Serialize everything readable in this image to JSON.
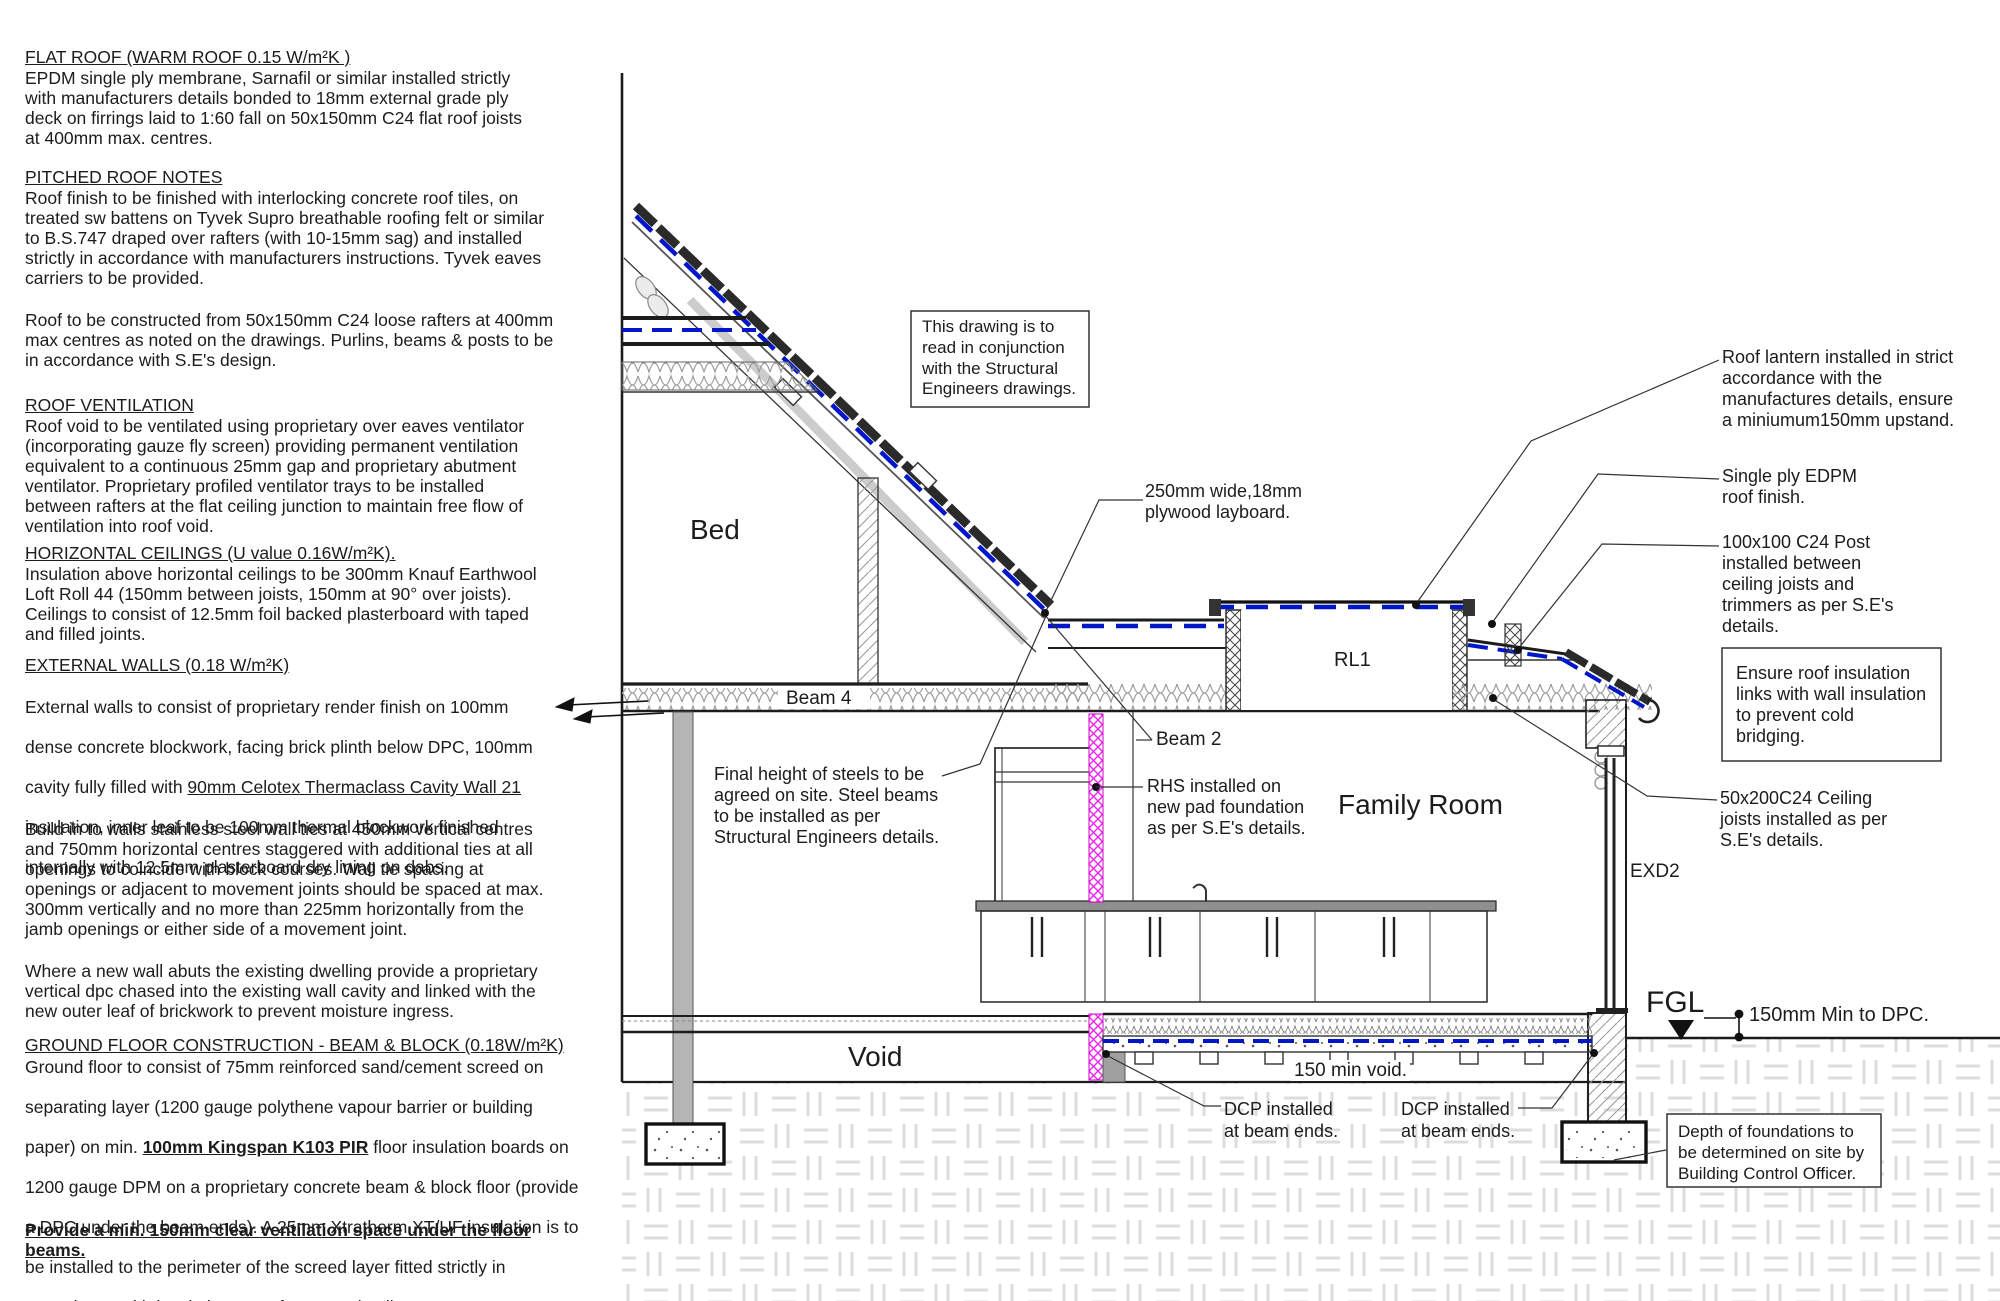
{
  "notes": {
    "flat_roof": {
      "heading": "FLAT ROOF (WARM ROOF 0.15 W/m²K )",
      "body": "EPDM single ply membrane, Sarnafil or similar installed strictly\nwith manufacturers details bonded to 18mm external grade ply\ndeck on firrings laid to 1:60 fall on 50x150mm C24 flat roof joists\nat 400mm max. centres."
    },
    "pitched": {
      "heading": "PITCHED ROOF NOTES",
      "body": "Roof finish to be finished with interlocking concrete roof tiles, on\ntreated sw battens on Tyvek Supro breathable roofing felt or similar\nto B.S.747 draped over rafters (with 10-15mm sag) and installed\nstrictly in accordance with manufacturers instructions. Tyvek eaves\ncarriers to be provided.",
      "body2": "Roof to be constructed from 50x150mm C24 loose rafters at 400mm\nmax centres as noted on the drawings. Purlins, beams & posts to be\nin accordance with S.E's design."
    },
    "ventilation": {
      "heading": "ROOF VENTILATION",
      "body": "Roof void to be ventilated using proprietary over eaves ventilator\n(incorporating gauze fly screen) providing permanent ventilation\nequivalent to a continuous 25mm gap and proprietary abutment\nventilator. Proprietary profiled ventilator trays to be installed\nbetween rafters at the flat ceiling junction to maintain free flow of\nventilation into roof void."
    },
    "ceilings": {
      "heading": "HORIZONTAL CEILINGS (U value 0.16W/m²K).",
      "body": "Insulation above horizontal ceilings to be 300mm Knauf Earthwool\nLoft Roll 44 (150mm between joists, 150mm at 90° over joists).\nCeilings to consist of 12.5mm foil backed plasterboard with taped\nand filled joints."
    },
    "walls": {
      "heading": "EXTERNAL WALLS (0.18 W/m²K)",
      "p1_l1": "External walls to consist of proprietary render finish on 100mm",
      "p1_l2": "dense concrete blockwork, facing brick plinth below DPC, 100mm",
      "p1_l3_pre": "cavity fully filled with ",
      "p1_l3_u": "90mm Celotex Thermaclass Cavity Wall 21",
      "p1_l4": "insulation, inner leaf to be 100mm thermal blockwork finished",
      "p1_l5": "internally with 12.5mm plasterboard dry lining on dabs.",
      "p2": "Build in to walls stainless steel wall ties at 450mm vertical centres\nand 750mm horizontal centres staggered with additional ties at all\nopenings to coincide with block courses. Wall tie spacing at\nopenings or adjacent to movement joints should be spaced at max.\n300mm vertically and no more than 225mm horizontally from the\njamb openings or either side of a movement joint.",
      "p3": "Where a new wall abuts the existing dwelling provide a proprietary\nvertical dpc chased into the existing wall cavity and linked with the\nnew outer leaf of brickwork to prevent moisture ingress."
    },
    "ground": {
      "heading": "GROUND FLOOR CONSTRUCTION - BEAM & BLOCK (0.18W/m²K)",
      "l1": "Ground floor to consist of 75mm reinforced sand/cement screed on",
      "l2": "separating layer (1200 gauge polythene vapour barrier or building",
      "l3_pre": "paper) on min. ",
      "l3_b": "100mm Kingspan K103 PIR",
      "l3_post": " floor insulation boards on",
      "l4": "1200 gauge DPM on a proprietary concrete beam & block floor (provide",
      "l5": "a DPC under the beam ends). A 25mm Xtratherm XT/UF insulation is to",
      "l6": "be installed to the perimeter of the screed layer fitted strictly in",
      "l7": "accordance with insulation manufacturers details.",
      "emphasis": "Provide a min. 150mm clear ventilation space under the floor\nbeams."
    }
  },
  "drawing": {
    "rooms": {
      "bed": "Bed",
      "family": "Family Room",
      "void": "Void"
    },
    "labels": {
      "beam4": "Beam 4",
      "beam2": "Beam 2",
      "rl1": "RL1",
      "exd2": "EXD2",
      "fgl": "FGL",
      "min_void": "150 min void.",
      "dim_dpc": "150mm Min to DPC.",
      "dcp_left": "DCP installed\nat beam ends.",
      "dcp_right": "DCP installed\nat beam ends."
    },
    "callouts": {
      "conjunction": "This drawing is to\nread in conjunction\nwith the Structural\nEngineers drawings.",
      "plywood": "250mm wide,18mm\nplywood layboard.",
      "final_height": "Final height of steels to be\nagreed on site. Steel beams\nto be installed as per\nStructural Engineers details.",
      "rhs": "RHS installed on\nnew pad foundation\nas per S.E's details.",
      "roof_lantern": "Roof lantern installed in strict\naccordance with the\nmanufactures details, ensure\na miniumum150mm upstand.",
      "single_ply": "Single ply EDPM\nroof finish.",
      "post": "100x100 C24 Post\ninstalled between\nceiling joists and\ntrimmers as per S.E's\ndetails.",
      "ensure": "Ensure roof insulation\nlinks with wall insulation\nto prevent cold\nbridging.",
      "ceiling_joists": "50x200C24 Ceiling\njoists installed as per\nS.E's details.",
      "depth": "Depth of foundations to\nbe determined on site by\nBuilding Control Officer."
    },
    "colors": {
      "membrane_blue": "#0016c8",
      "rhs_magenta": "#ee22ee",
      "line": "#1c1c1c"
    }
  }
}
